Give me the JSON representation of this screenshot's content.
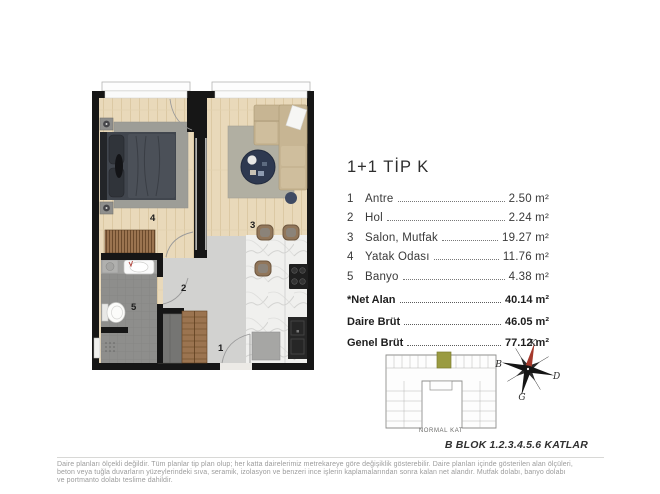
{
  "unit": {
    "title": "1+1 TİP K",
    "rooms": [
      {
        "num": "1",
        "name": "Antre",
        "area": "2.50 m²"
      },
      {
        "num": "2",
        "name": "Hol",
        "area": "2.24 m²"
      },
      {
        "num": "3",
        "name": "Salon, Mutfak",
        "area": "19.27 m²"
      },
      {
        "num": "4",
        "name": "Yatak Odası",
        "area": "11.76 m²"
      },
      {
        "num": "5",
        "name": "Banyo",
        "area": "4.38 m²"
      }
    ],
    "summary": [
      {
        "label": "*Net Alan",
        "value": "40.14 m²"
      },
      {
        "label": "Daire Brüt",
        "value": "46.05 m²"
      },
      {
        "label": "Genel Brüt",
        "value": "77.12 m²"
      }
    ]
  },
  "key_plan": {
    "caption": "NORMAL KAT",
    "block_label": "B BLOK 1.2.3.4.5.6 KATLAR",
    "highlight_color": "#9a9b41"
  },
  "compass": {
    "north": "K",
    "east": "D",
    "south": "G",
    "west": "B",
    "north_color": "#a5392c"
  },
  "footer": {
    "lines": [
      "Daire planları ölçekli değildir. Tüm planlar tip plan olup; her katta dairelerimiz metrekareye göre değişiklik gösterebilir. Daire planları içinde gösterilen alan ölçüleri,",
      "beton veya tuğla duvarların yüzeylerindeki sıva, seramik, izolasyon ve benzeri ince işlerin kaplamalarından sonra kalan net alandır. Mutfak dolabı, banyo dolabı",
      "ve portmanto dolabı teslime dahildir."
    ]
  }
}
